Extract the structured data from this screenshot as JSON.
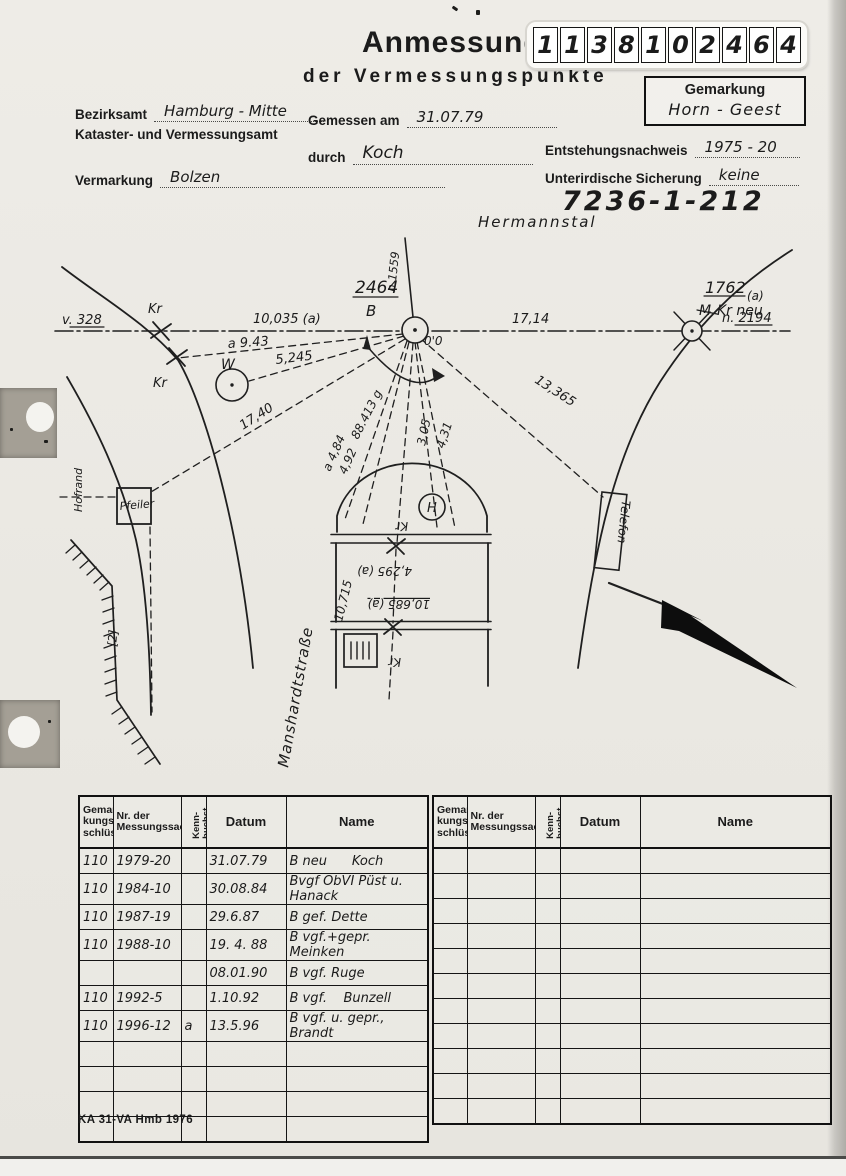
{
  "header": {
    "title": "Anmessung",
    "subtitle": "der Vermessungspunkte",
    "number_digits": [
      "1",
      "1",
      "3",
      "8",
      "1",
      "0",
      "2",
      "4",
      "6",
      "4"
    ],
    "gemarkung_label": "Gemarkung",
    "gemarkung_value": "Horn - Geest",
    "bezirksamt_label": "Bezirksamt",
    "bezirksamt_value": "Hamburg - Mitte",
    "amt_line": "Kataster- und Vermessungsamt",
    "gemessen_label": "Gemessen am",
    "gemessen_value": "31.07.79",
    "durch_label": "durch",
    "durch_value": "Koch",
    "entstehung_label": "Entstehungsnachweis",
    "entstehung_value": "1975 - 20",
    "vermarkung_label": "Vermarkung",
    "vermarkung_value": "Bolzen",
    "sicherung_label": "Unterirdische Sicherung",
    "sicherung_value": "keine",
    "point_id": "7236-1-212"
  },
  "sketch": {
    "street_top": "Hermannstal",
    "street_left": "Manshardtstraße",
    "n1559": "n.1559",
    "v328": "v. 328",
    "m10035": "10,035 (a)",
    "m1714": "17,14",
    "n2194": "n. 2194",
    "point_main_no": "2464",
    "point_main_letter": "B",
    "angle_zero": "0'0",
    "kr_top": "Kr",
    "kr_bottom": "Kr",
    "m943": "a 9.43",
    "w_label": "W",
    "m5245": "5,245",
    "m1740": "17,40",
    "m88413": "88.413 g",
    "m484": "a 4,84",
    "m492": "4,92",
    "m305": "3,05",
    "m431": "4,31",
    "m13365": "13,365",
    "point_right_no": "1762",
    "point_right_a": "(a)",
    "point_right_old": "M",
    "point_right_name": "Kr neu",
    "hofrand": "Hofrand",
    "pfeiler": "Pfeiler",
    "slope_note": "[2]",
    "telefon": "Telefon",
    "h_label": "H",
    "kr_dome": "Kr",
    "m4295": "4,295 (a)",
    "m10685": "10,685 (a)",
    "m10715": "10,715",
    "kr_lower": "Kr"
  },
  "table": {
    "headers": {
      "gem": "Gemar-\nkungs-\nschlüssel",
      "nr": "Nr. der\nMessungssache",
      "kenn": "Kenn-\nbuchst.",
      "datum": "Datum",
      "name": "Name"
    },
    "rows": [
      {
        "g": "110",
        "nr": "1979-20",
        "k": "",
        "datum": "31.07.79",
        "name": "B neu      Koch"
      },
      {
        "g": "110",
        "nr": "1984-10",
        "k": "",
        "datum": "30.08.84",
        "name": "Bvgf ÖbVI Püst u. Hanack"
      },
      {
        "g": "110",
        "nr": "1987-19",
        "k": "",
        "datum": "29.6.87",
        "name": "B gef. Dette"
      },
      {
        "g": "110",
        "nr": "1988-10",
        "k": "",
        "datum": "19. 4. 88",
        "name": "B vgf.+gepr. Meinken"
      },
      {
        "g": "",
        "nr": "",
        "k": "",
        "datum": "08.01.90",
        "name": "B vgf. Ruge"
      },
      {
        "g": "110",
        "nr": "1992-5",
        "k": "",
        "datum": "1.10.92",
        "name": "B vgf.    Bunzell"
      },
      {
        "g": "110",
        "nr": "1996-12",
        "k": "a",
        "datum": "13.5.96",
        "name": "B vgf. u. gepr., Brandt"
      }
    ]
  },
  "footer": {
    "form_code": "KA 31-VA Hmb 1976"
  }
}
